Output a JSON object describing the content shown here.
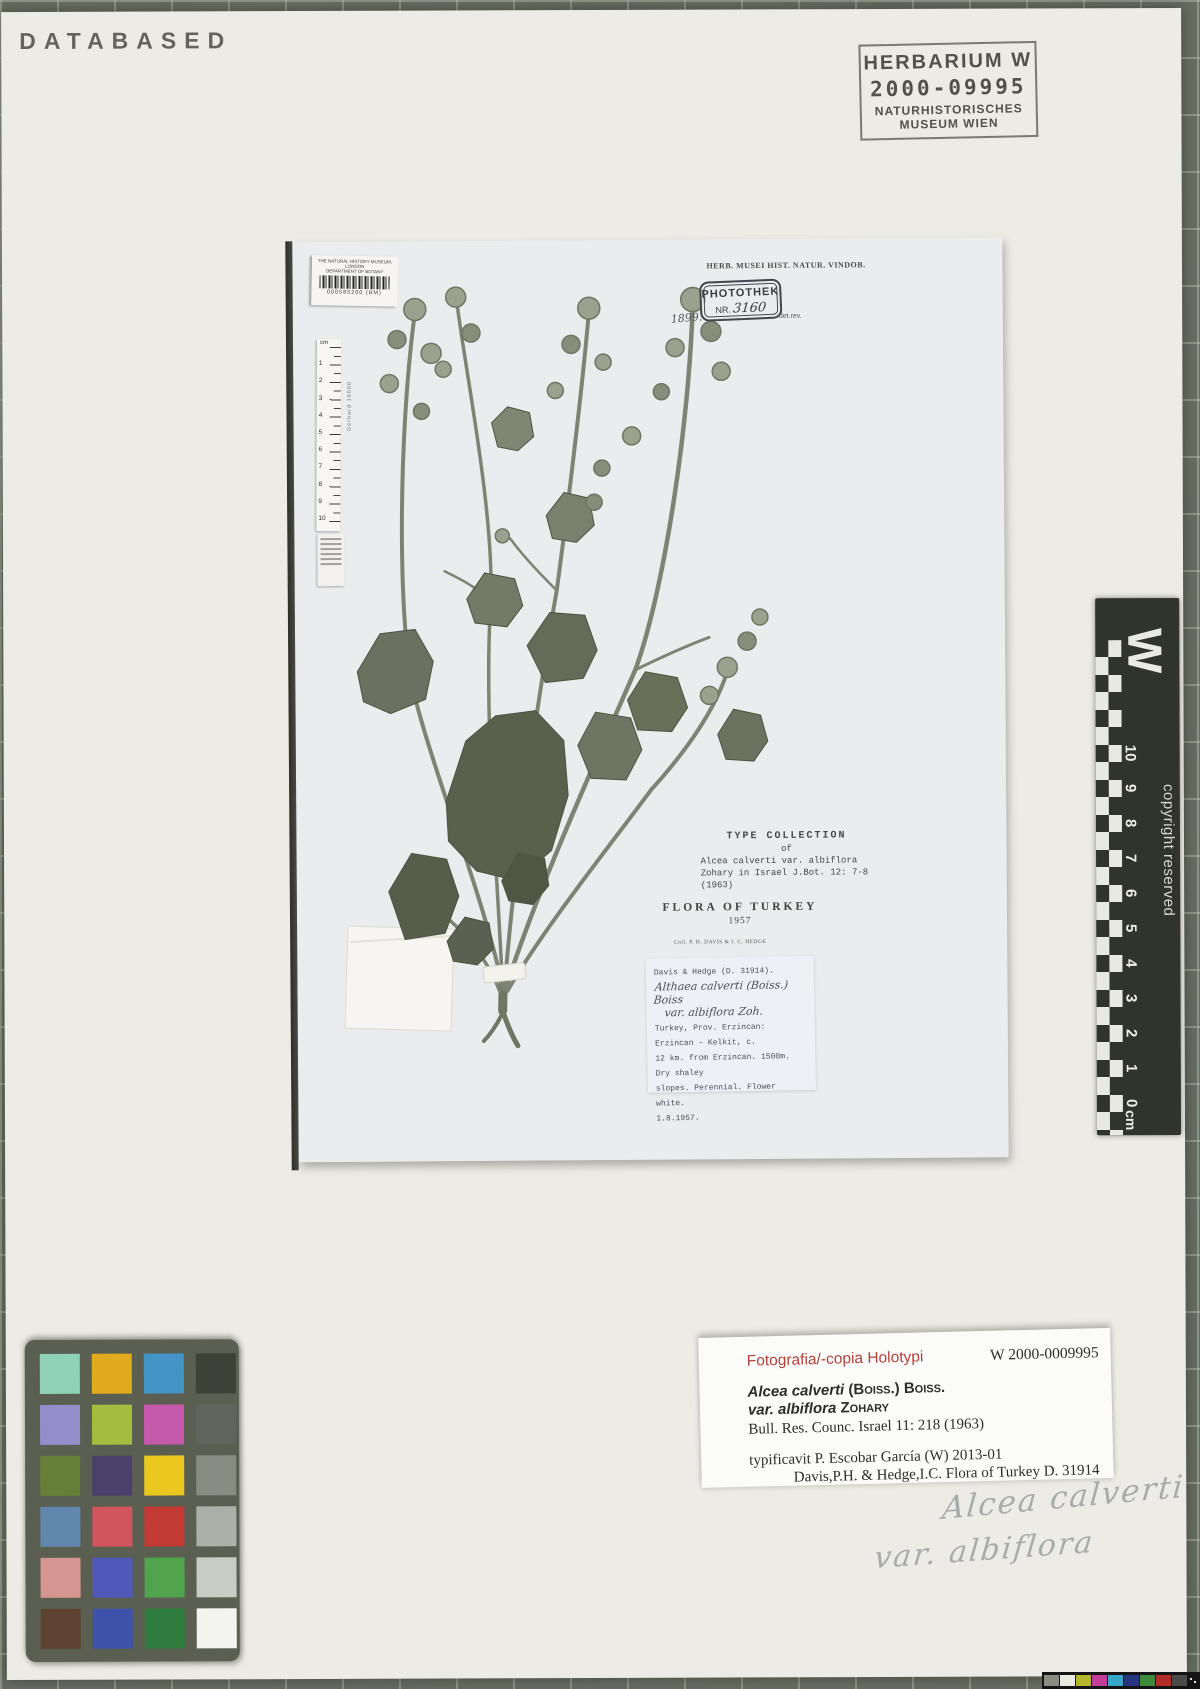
{
  "stamps": {
    "databased": "DATABASED",
    "herbarium": {
      "title": "HERBARIUM W",
      "number": "2000-09995",
      "line3": "NATURHISTORISCHES",
      "line4": "MUSEUM WIEN"
    }
  },
  "sheet": {
    "header": "HERB. MUSEI HIST. NATUR. VINDOB.",
    "bm_label": {
      "line1": "THE NATURAL HISTORY MUSEUM, LONDON",
      "line2": "DEPARTMENT OF BOTANY",
      "number": "000585200 (BM)"
    },
    "photothek": {
      "title": "PHOTOTHEK",
      "nr_label": "NR.",
      "nr_value": "3160",
      "year": "1899.",
      "det_note": "det.rev."
    },
    "ruler": {
      "unit": "cm",
      "brand": "Gerhard 10000",
      "numbers": [
        "1",
        "2",
        "3",
        "4",
        "5",
        "6",
        "7",
        "8",
        "9",
        "10"
      ]
    },
    "type_collection": {
      "lines": [
        "TYPE COLLECTION",
        "of",
        "Alcea calverti var. albiflora",
        "Zohary in Israel J.Bot. 12: 7-8",
        "(1963)"
      ]
    },
    "flora_label": {
      "title": "FLORA OF TURKEY",
      "year": "1957",
      "collector": "Coll. P. H. DAVIS & I. C. HEDGE"
    },
    "davis_label": {
      "header": "Davis & Hedge (D. 31914).",
      "species": "Althaea calverti (Boiss.) Boiss",
      "variety": "var. albiflora Zoh.",
      "lines": [
        "Turkey, Prov. Erzincan: Erzincan - Kelkit, c.",
        "12 km. from Erzincan. 1500m. Dry shaley",
        "slopes.   Perennial.   Flower white.",
        "1.8.1957."
      ]
    }
  },
  "scale_bar": {
    "letter": "W",
    "copyright": "copyright reserved",
    "unit": "cm",
    "numbers": [
      "0",
      "1",
      "2",
      "3",
      "4",
      "5",
      "6",
      "7",
      "8",
      "9",
      "10"
    ]
  },
  "annotation_label": {
    "red_title": "Fotografia/-copia Holotypi",
    "herbar_number": "W 2000-0009995",
    "species": "Alcea calverti",
    "species_author": "(Boiss.) Boiss.",
    "variety": "var. albiflora",
    "variety_author": "Zohary",
    "citation": "Bull. Res. Counc. Israel 11: 218 (1963)",
    "typification": "typificavit P. Escobar García (W)  2013-01",
    "collection_ref": "Davis,P.H. & Hedge,I.C. Flora of Turkey D. 31914"
  },
  "handwriting": {
    "line1": "Alcea calverti",
    "line2": "var. albiflora"
  },
  "color_checker": {
    "card_color": "#5a5f52",
    "rows": [
      [
        "#8ed0b8",
        "#e2aa1f",
        "#4494c6",
        "#3d4136"
      ],
      [
        "#938ec9",
        "#a6bc40",
        "#c659ac",
        "#60645d"
      ],
      [
        "#66803a",
        "#49406b",
        "#eac81f",
        "#888d82"
      ],
      [
        "#6187ac",
        "#d0555c",
        "#c23a33",
        "#adb0a9"
      ],
      [
        "#d69690",
        "#5058b8",
        "#52a34d",
        "#c9cbc5"
      ],
      [
        "#5c422f",
        "#3d52a8",
        "#2e7d3e",
        "#f3f3f0"
      ]
    ]
  },
  "footer_bar": {
    "patches": [
      "#8c8c86",
      "#e9e9e3",
      "#b5b52e",
      "#c23e98",
      "#36a6c9",
      "#27357e",
      "#3e8a3c",
      "#b32d28",
      "#4a4a46"
    ]
  }
}
